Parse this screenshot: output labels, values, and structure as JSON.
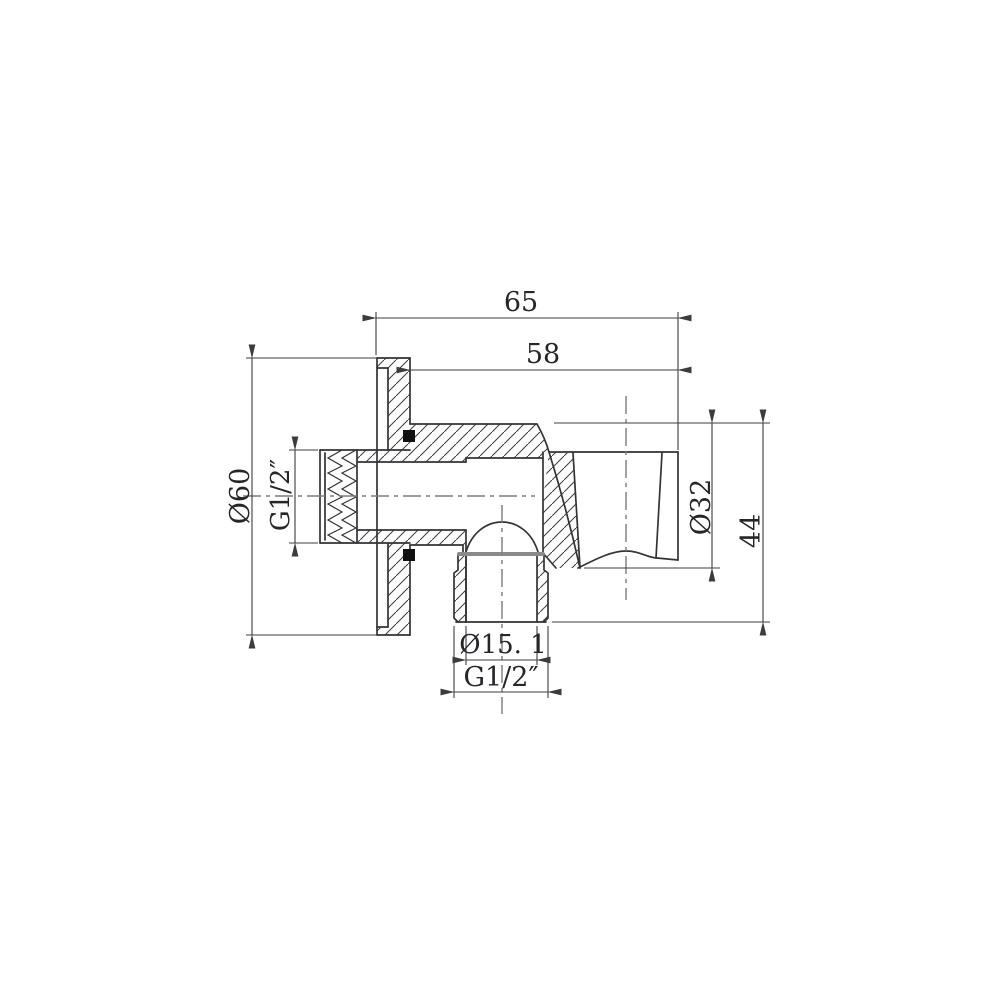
{
  "drawing": {
    "type": "technical-section-drawing",
    "subject": "shower wall outlet elbow with handset holder, cross-section",
    "dimensions": [
      {
        "id": "overall-width",
        "label": "65",
        "orientation": "horizontal",
        "location": "top"
      },
      {
        "id": "body-width",
        "label": "58",
        "orientation": "horizontal",
        "location": "top"
      },
      {
        "id": "flange-diameter",
        "label": "Ø60",
        "orientation": "vertical",
        "location": "left"
      },
      {
        "id": "inlet-thread",
        "label": "G1/2″",
        "orientation": "vertical",
        "location": "left"
      },
      {
        "id": "holder-diameter",
        "label": "Ø32",
        "orientation": "vertical",
        "location": "right"
      },
      {
        "id": "outlet-height",
        "label": "44",
        "orientation": "vertical",
        "location": "right"
      },
      {
        "id": "outlet-bore",
        "label": "Ø15. 1",
        "orientation": "horizontal",
        "location": "bottom"
      },
      {
        "id": "outlet-thread",
        "label": "G1/2″",
        "orientation": "horizontal",
        "location": "bottom"
      }
    ],
    "colors": {
      "background": "#ffffff",
      "outline": "#333336",
      "dimension_lines": "#3c3c40",
      "centerline": "#7b7b7e",
      "seal": "#111111",
      "bore_end_edge": "#8a8a8a"
    }
  }
}
